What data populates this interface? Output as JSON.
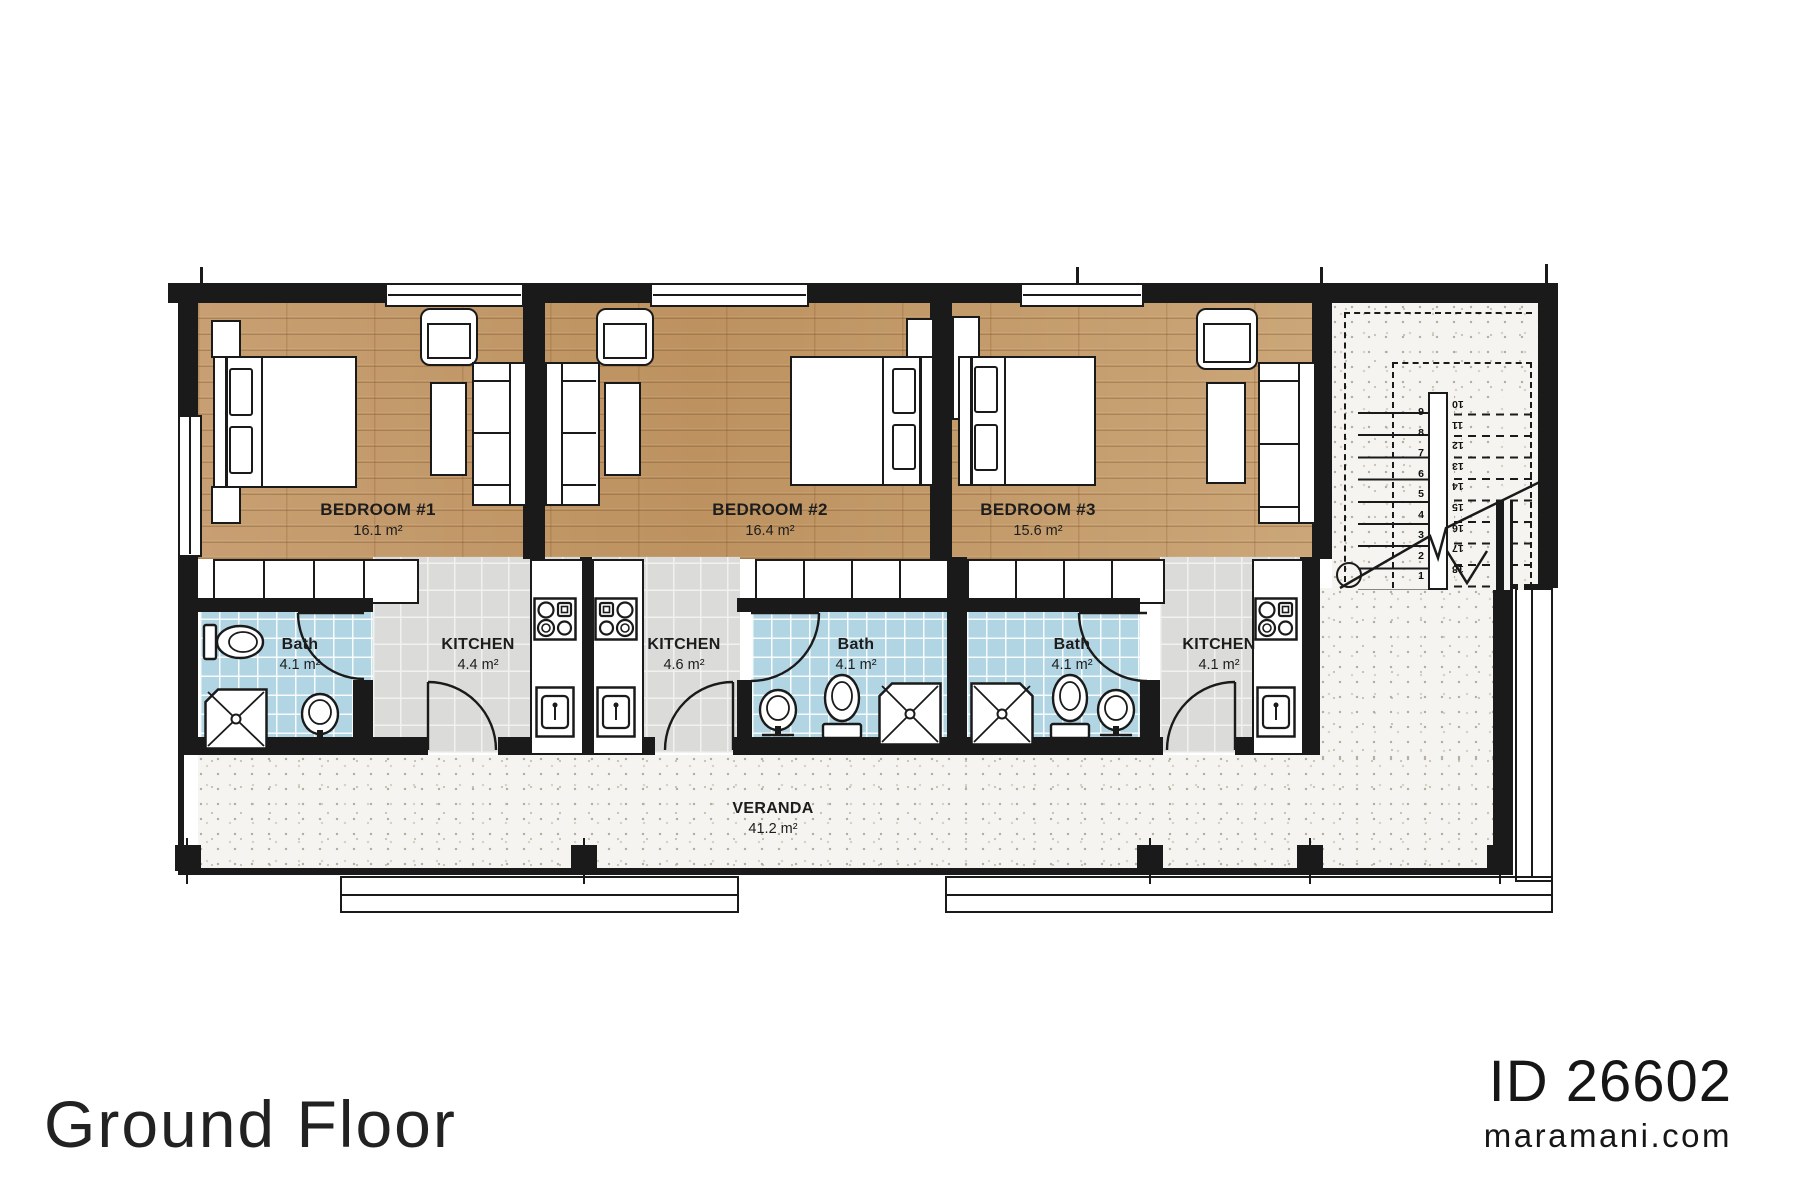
{
  "floor": {
    "label": "Ground Floor"
  },
  "branding": {
    "plan_id": "ID 26602",
    "website": "maramani.com"
  },
  "rooms": {
    "bedroom1": {
      "name": "BEDROOM #1",
      "area": "16.1 m²"
    },
    "bedroom2": {
      "name": "BEDROOM #2",
      "area": "16.4 m²"
    },
    "bedroom3": {
      "name": "BEDROOM #3",
      "area": "15.6 m²"
    },
    "bath1": {
      "name": "Bath",
      "area": "4.1 m²"
    },
    "bath2": {
      "name": "Bath",
      "area": "4.1 m²"
    },
    "bath3": {
      "name": "Bath",
      "area": "4.1 m²"
    },
    "kitchen1": {
      "name": "KITCHEN",
      "area": "4.4 m²"
    },
    "kitchen2": {
      "name": "KITCHEN",
      "area": "4.6 m²"
    },
    "kitchen3": {
      "name": "KITCHEN",
      "area": "4.1 m²"
    },
    "veranda": {
      "name": "VERANDA",
      "area": "41.2 m²"
    }
  },
  "stairs": {
    "down_numbers": [
      "1",
      "2",
      "3",
      "4",
      "5",
      "6",
      "7",
      "8",
      "9"
    ],
    "up_numbers": [
      "10",
      "11",
      "12",
      "13",
      "14",
      "15",
      "16",
      "17",
      "18"
    ]
  },
  "colors": {
    "wall": "#1a1a1a",
    "wood_floor": "#c59e70",
    "bath_tile": "#b2d5e4",
    "kitchen_tile": "#dbdbd9",
    "veranda_floor": "#f5f4f0"
  }
}
